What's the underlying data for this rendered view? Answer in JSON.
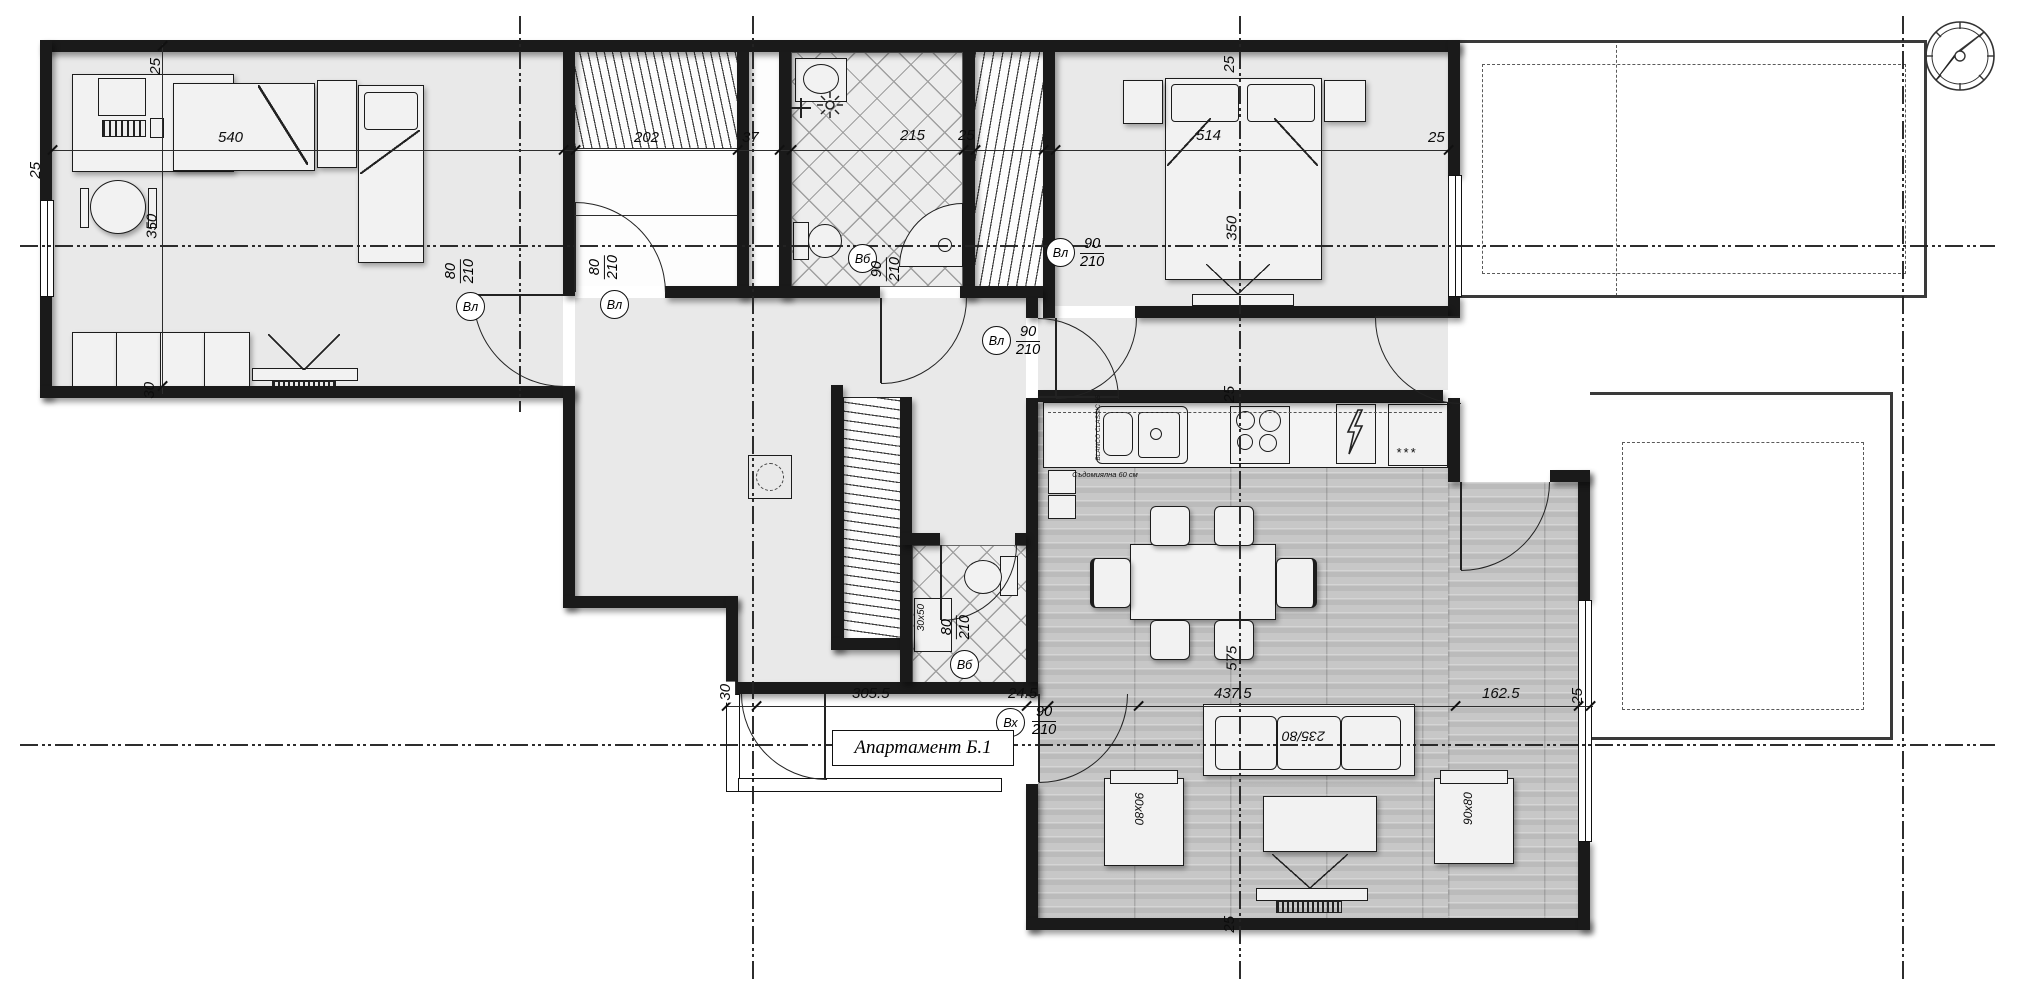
{
  "labels": {
    "title": "Апартамент Б.1",
    "sofa": "235/80",
    "armchair_left": "90x80",
    "armchair_right": "90x80",
    "wc_sink": "30x50"
  },
  "kitchen": {
    "sink": "BLANCO CLASSIC 55",
    "dishwasher": "Съдомиялна 60 см",
    "fridge_stars": "***"
  },
  "dims": {
    "top_wall_25": "25",
    "left_wall_25": "25",
    "bedroom1_540": "540",
    "bedroom1_350": "350",
    "bedroom1_30": "30",
    "closet_202": "202",
    "shaft_37": "37",
    "bath_215": "215",
    "bath_25": "25",
    "bedroom2_514": "514",
    "bedroom2_25r": "25",
    "ax_top_25": "25",
    "bedroom2_350": "350",
    "kitchen_25": "25",
    "living_575": "575",
    "bottom_wall_25": "25",
    "entry_30": "30",
    "hall_305_5": "305.5",
    "seg_24_5": "24.5",
    "living_437_5": "437.5",
    "terrace_162_5": "162.5",
    "right_25": "25"
  },
  "doors": {
    "bedroom1": {
      "tag": "Вл",
      "w": "80",
      "h": "210"
    },
    "closet": {
      "tag": "Вл",
      "w": "80",
      "h": "210"
    },
    "bathroom": {
      "tag": "Вб",
      "w": "90",
      "h": "210"
    },
    "bedroom2": {
      "tag": "Вл",
      "w": "90",
      "h": "210"
    },
    "living": {
      "tag": "Вл",
      "w": "90",
      "h": "210"
    },
    "wc": {
      "tag": "Вб",
      "w": "80",
      "h": "210"
    },
    "entrance": {
      "tag": "Вх",
      "w": "90",
      "h": "210"
    }
  },
  "icons": {
    "compass": "compass-rose-icon",
    "electric_panel": "lightning-icon",
    "shower": "shower-head-icon",
    "faucet": "faucet-cross-icon"
  },
  "colors": {
    "wall": "#1a1a1a",
    "interior": "#e9e9e9",
    "parquet": "#c7c7c7",
    "line": "#222222"
  }
}
